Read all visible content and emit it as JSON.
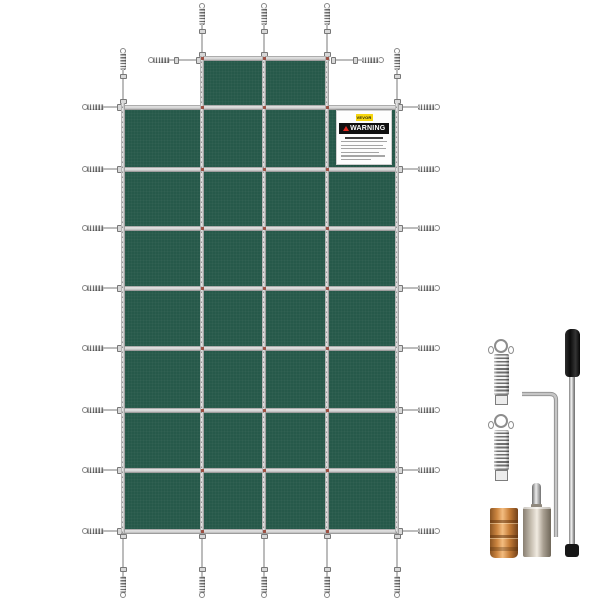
{
  "scene": {
    "type": "product-photo",
    "background": "#ffffff"
  },
  "pool_cover": {
    "fabric_color": "#26594a",
    "strap_color": "#cdcdcd",
    "stitch_dot_color": "#9c4f42",
    "grid": {
      "columns": 4,
      "rows": 7,
      "top_section_cells": 2
    }
  },
  "warning_label": {
    "brand": "VEVOR",
    "brand_bg": "#f6d60f",
    "warning_text": "WARNING",
    "warning_bar_bg": "#101010",
    "warning_triangle_color": "#e3281e",
    "fine_print_lines": 6
  },
  "accessory_kit": {
    "items": [
      {
        "name": "tension-spring-1"
      },
      {
        "name": "tension-spring-2"
      },
      {
        "name": "hex-key"
      },
      {
        "name": "installation-rod"
      },
      {
        "name": "brass-anchor"
      },
      {
        "name": "anchor-with-pin"
      }
    ],
    "brass_color": "#c9833f",
    "nickel_color": "#cfc7ba",
    "rod_handle_color": "#111111"
  }
}
